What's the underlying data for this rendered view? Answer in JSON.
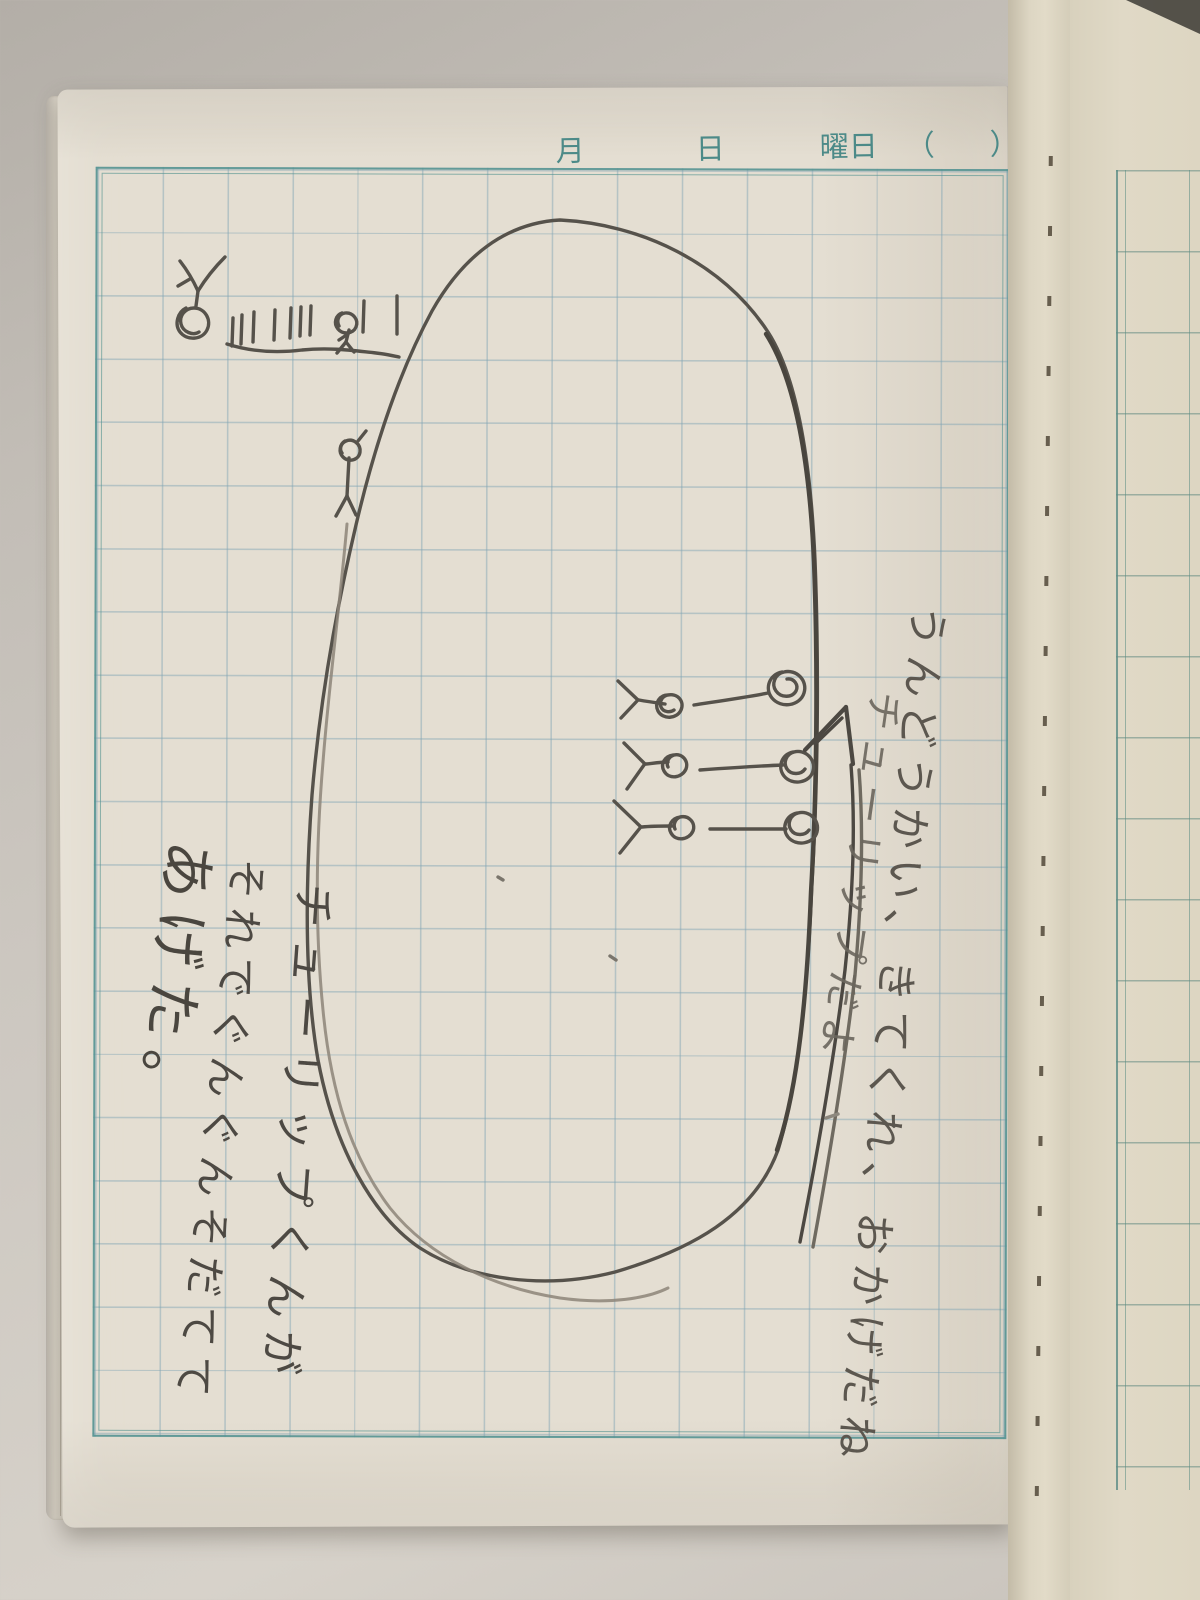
{
  "header": {
    "month": "月",
    "day": "日",
    "weekday": "曜日",
    "paren_open": "（",
    "paren_close": "）"
  },
  "handwriting": {
    "right_column_1": "うんどうかい、きてくれ、おかげだね",
    "right_column_2": "チューリップだよ",
    "left_column_1": "チューリップくんが",
    "left_column_2": "それでぐんぐんそだてて",
    "left_column_3": "あげた。"
  },
  "drawing_icons": {
    "field_oval": "large-oval-field",
    "figure_arms_up": "stick-figure-arms-raised",
    "fence": "fence-tally-marks-with-child",
    "walking_figure": "small-stick-figure",
    "tulips": "three-tulip-sprouts-with-scribbled-blooms",
    "arrow": "double-line-arrow-pointing-at-tulips"
  },
  "colors": {
    "paper": "#e4ded2",
    "grid_line": "#a3bcc6",
    "frame_teal": "#549390",
    "pencil": "#55504a",
    "backdrop": "#c6c1ba",
    "facing_page": "#ded7c4"
  }
}
